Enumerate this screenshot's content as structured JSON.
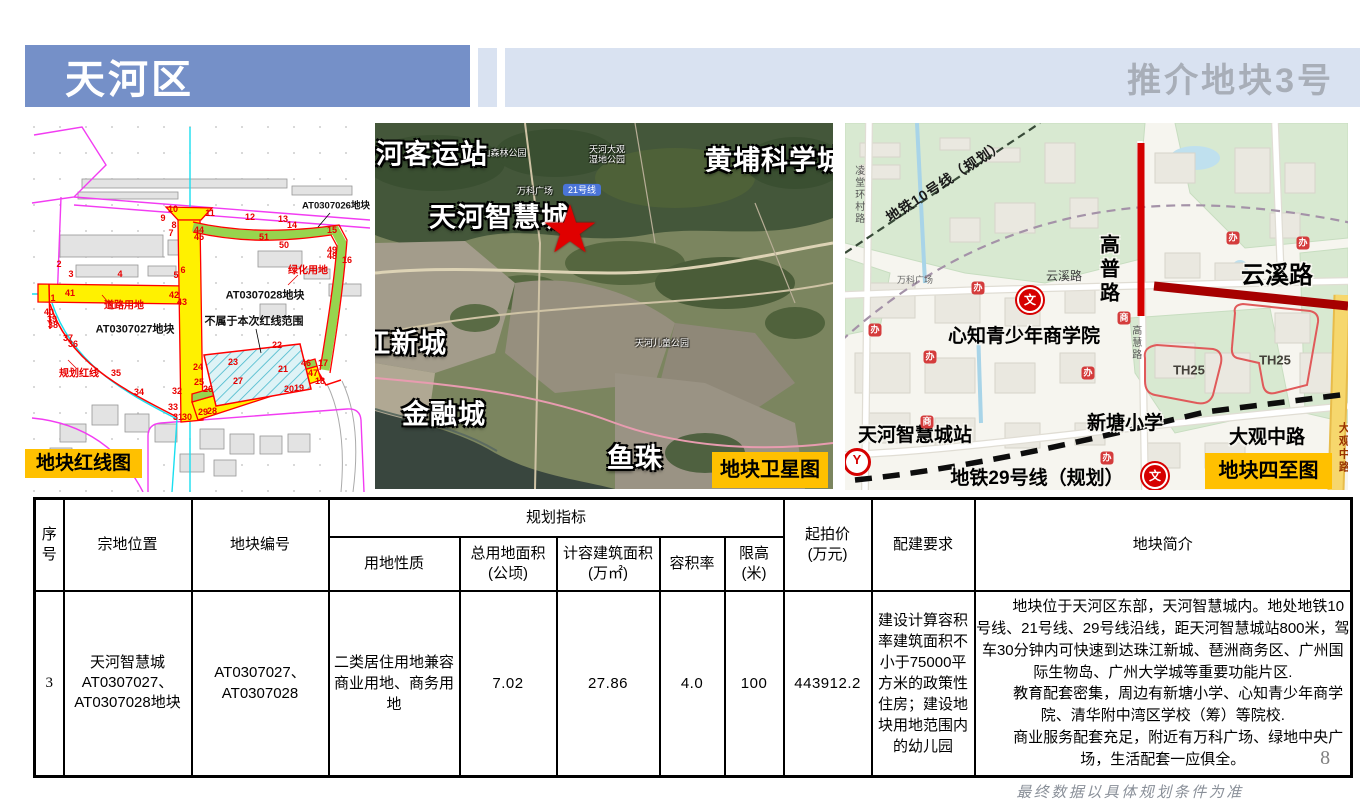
{
  "header": {
    "district_title": "天河区",
    "right_title": "推介地块3号"
  },
  "captions": {
    "redline": "地块红线图",
    "satellite": "地块卫星图",
    "bounds": "地块四至图"
  },
  "colors": {
    "header_blue": "#7590c8",
    "header_light": "#d9e2f1",
    "title_gray": "#a8aeb8",
    "caption_orange": "#ffc000",
    "redline_red": "#ff0000",
    "road_yellow": "#fff100",
    "green_strip": "#97d44e",
    "highlight_red": "#a60000"
  },
  "redline_map": {
    "labels": [
      {
        "t": "AT0307026地块",
        "x": 306,
        "y": 84,
        "c": "rl-blk-sm"
      },
      {
        "t": "AT0307028地块",
        "x": 235,
        "y": 173,
        "c": "rl-blk"
      },
      {
        "t": "AT0307027地块",
        "x": 105,
        "y": 207,
        "c": "rl-blk"
      },
      {
        "t": "不属于本次红线范围",
        "x": 224,
        "y": 199,
        "c": "rl-blk"
      },
      {
        "t": "绿化用地",
        "x": 278,
        "y": 148,
        "c": "rl-red"
      },
      {
        "t": "道路用地",
        "x": 94,
        "y": 183,
        "c": "rl-red"
      },
      {
        "t": "规划红线",
        "x": 49,
        "y": 251,
        "c": "rl-red"
      }
    ],
    "vertices": [
      [
        "10",
        143,
        86
      ],
      [
        "9",
        133,
        95
      ],
      [
        "8",
        144,
        102
      ],
      [
        "7",
        141,
        110
      ],
      [
        "11",
        180,
        90
      ],
      [
        "12",
        220,
        94
      ],
      [
        "13",
        253,
        96
      ],
      [
        "14",
        262,
        102
      ],
      [
        "15",
        302,
        107
      ],
      [
        "44",
        169,
        107
      ],
      [
        "45",
        169,
        114
      ],
      [
        "51",
        234,
        114
      ],
      [
        "50",
        254,
        122
      ],
      [
        "49",
        302,
        127
      ],
      [
        "48",
        302,
        133
      ],
      [
        "16",
        317,
        137
      ],
      [
        "2",
        29,
        141
      ],
      [
        "6",
        153,
        147
      ],
      [
        "5",
        146,
        152
      ],
      [
        "3",
        41,
        151
      ],
      [
        "4",
        90,
        151
      ],
      [
        "41",
        40,
        170
      ],
      [
        "1",
        23,
        175
      ],
      [
        "42",
        144,
        172
      ],
      [
        "43",
        152,
        179
      ],
      [
        "40",
        19,
        189
      ],
      [
        "39",
        22,
        196
      ],
      [
        "38",
        23,
        202
      ],
      [
        "37",
        38,
        215
      ],
      [
        "36",
        43,
        221
      ],
      [
        "35",
        86,
        250
      ],
      [
        "34",
        109,
        269
      ],
      [
        "32",
        147,
        268
      ],
      [
        "33",
        143,
        284
      ],
      [
        "31",
        148,
        294
      ],
      [
        "30",
        157,
        294
      ],
      [
        "29",
        173,
        289
      ],
      [
        "28",
        182,
        288
      ],
      [
        "26",
        178,
        266
      ],
      [
        "25",
        169,
        259
      ],
      [
        "24",
        168,
        244
      ],
      [
        "23",
        203,
        239
      ],
      [
        "27",
        208,
        258
      ],
      [
        "22",
        247,
        222
      ],
      [
        "21",
        253,
        246
      ],
      [
        "20",
        259,
        266
      ],
      [
        "19",
        269,
        265
      ],
      [
        "46",
        276,
        240
      ],
      [
        "47",
        283,
        250
      ],
      [
        "18",
        290,
        258
      ],
      [
        "17",
        293,
        240
      ]
    ]
  },
  "satellite_map": {
    "labels": [
      {
        "t": "天河客运站",
        "x": 43,
        "y": 32,
        "c": "sat-big"
      },
      {
        "t": "黄埔科学城",
        "x": 400,
        "y": 38,
        "c": "sat-big"
      },
      {
        "t": "天河智慧城",
        "x": 124,
        "y": 95,
        "c": "sat-big"
      },
      {
        "t": "★",
        "x": 195,
        "y": 107,
        "c": "sat-star"
      },
      {
        "t": "珠江新城",
        "x": 16,
        "y": 221,
        "c": "sat-big"
      },
      {
        "t": "金融城",
        "x": 69,
        "y": 292,
        "c": "sat-big"
      },
      {
        "t": "鱼珠",
        "x": 260,
        "y": 336,
        "c": "sat-big"
      }
    ],
    "pois": [
      {
        "t": "火炉山森林公园",
        "x": 120,
        "y": 30,
        "c": "sat-poi"
      },
      {
        "t": "天河大观\n湿地公园",
        "x": 232,
        "y": 32,
        "c": "sat-poi"
      },
      {
        "t": "天河儿童公园",
        "x": 287,
        "y": 220,
        "c": "sat-poi"
      },
      {
        "t": "21号线",
        "x": 207,
        "y": 67,
        "c": "sat-badge"
      },
      {
        "t": "万科广场",
        "x": 160,
        "y": 68,
        "c": "sat-poi"
      }
    ]
  },
  "bounds_map": {
    "labels": [
      {
        "t": "地铁10号线（规划）",
        "x": 100,
        "y": 58,
        "c": "bm10"
      },
      {
        "t": "凌堂环村路",
        "x": 13,
        "y": 72,
        "c": "bvsm"
      },
      {
        "t": "高普路",
        "x": 262,
        "y": 147,
        "c": "bvert"
      },
      {
        "t": "云溪路",
        "x": 432,
        "y": 153,
        "c": "bb2"
      },
      {
        "t": "云溪路",
        "x": 219,
        "y": 154,
        "c": "bsm"
      },
      {
        "t": "高慧路",
        "x": 290,
        "y": 220,
        "c": "bvsm"
      },
      {
        "t": "心知青少年商学院",
        "x": 179,
        "y": 214,
        "c": "bb"
      },
      {
        "t": "TH25",
        "x": 344,
        "y": 248,
        "c": "bth"
      },
      {
        "t": "TH25",
        "x": 430,
        "y": 238,
        "c": "bth"
      },
      {
        "t": "新塘小学",
        "x": 280,
        "y": 301,
        "c": "bb"
      },
      {
        "t": "大观中路",
        "x": 422,
        "y": 315,
        "c": "bb"
      },
      {
        "t": "大观中路",
        "x": 498,
        "y": 325,
        "c": "bvred"
      },
      {
        "t": "天河智慧城站",
        "x": 70,
        "y": 313,
        "c": "bb"
      },
      {
        "t": "地铁29号线（规划）",
        "x": 192,
        "y": 356,
        "c": "bb"
      },
      {
        "t": "万科广场",
        "x": 70,
        "y": 157,
        "c": "bsm2"
      },
      {
        "t": "文",
        "x": 185,
        "y": 177,
        "c": "icon-wen"
      },
      {
        "t": "文",
        "x": 310,
        "y": 353,
        "c": "icon-wen"
      },
      {
        "t": "Y",
        "x": 12,
        "y": 339,
        "c": "icon-metro"
      },
      {
        "t": "办",
        "x": 30,
        "y": 207,
        "c": "icon-ban"
      },
      {
        "t": "办",
        "x": 85,
        "y": 234,
        "c": "icon-ban"
      },
      {
        "t": "办",
        "x": 133,
        "y": 165,
        "c": "icon-ban"
      },
      {
        "t": "办",
        "x": 243,
        "y": 250,
        "c": "icon-ban"
      },
      {
        "t": "办",
        "x": 262,
        "y": 335,
        "c": "icon-ban"
      },
      {
        "t": "办",
        "x": 388,
        "y": 115,
        "c": "icon-ban"
      },
      {
        "t": "办",
        "x": 458,
        "y": 120,
        "c": "icon-ban"
      },
      {
        "t": "商",
        "x": 279,
        "y": 195,
        "c": "icon-shang"
      },
      {
        "t": "商",
        "x": 82,
        "y": 299,
        "c": "icon-shang"
      }
    ]
  },
  "table": {
    "headers": {
      "xuhao": "序号",
      "zongdi": "宗地位置",
      "bianhao": "地块编号",
      "guihua": "规划指标",
      "yongdi": "用地性质",
      "zongyongdi": "总用地面积\n(公顷)",
      "jirong": "计容建筑面积\n(万㎡)",
      "rongjilv": "容积率",
      "xiangao": "限高\n(米)",
      "qipaijia": "起拍价\n(万元)",
      "peijian": "配建要求",
      "jianjie": "地块简介"
    },
    "row": {
      "xuhao": "3",
      "zongdi": "天河智慧城\nAT0307027、\nAT0307028地块",
      "bianhao": "AT0307027、\nAT0307028",
      "yongdi": "二类居住用地兼容商业用地、商务用地",
      "zongyongdi": "7.02",
      "jirong": "27.86",
      "rongjilv": "4.0",
      "xiangao": "100",
      "qipaijia": "443912.2",
      "peijian": "建设计算容积率建筑面积不小于75000平方米的政策性住房；建设地块用地范围内的幼儿园",
      "intro_paragraphs": [
        "地块位于天河区东部，天河智慧城内。地处地铁10号线、21号线、29号线沿线，距天河智慧城站800米，驾车30分钟内可快速到达珠江新城、琶洲商务区、广州国际生物岛、广州大学城等重要功能片区.",
        "教育配套密集，周边有新塘小学、心知青少年商学院、清华附中湾区学校（筹）等院校.",
        "商业服务配套充足，附近有万科广场、绿地中央广场，生活配套一应俱全。"
      ]
    }
  },
  "footer": {
    "page_number": "8",
    "note": "最终数据以具体规划条件为准"
  }
}
